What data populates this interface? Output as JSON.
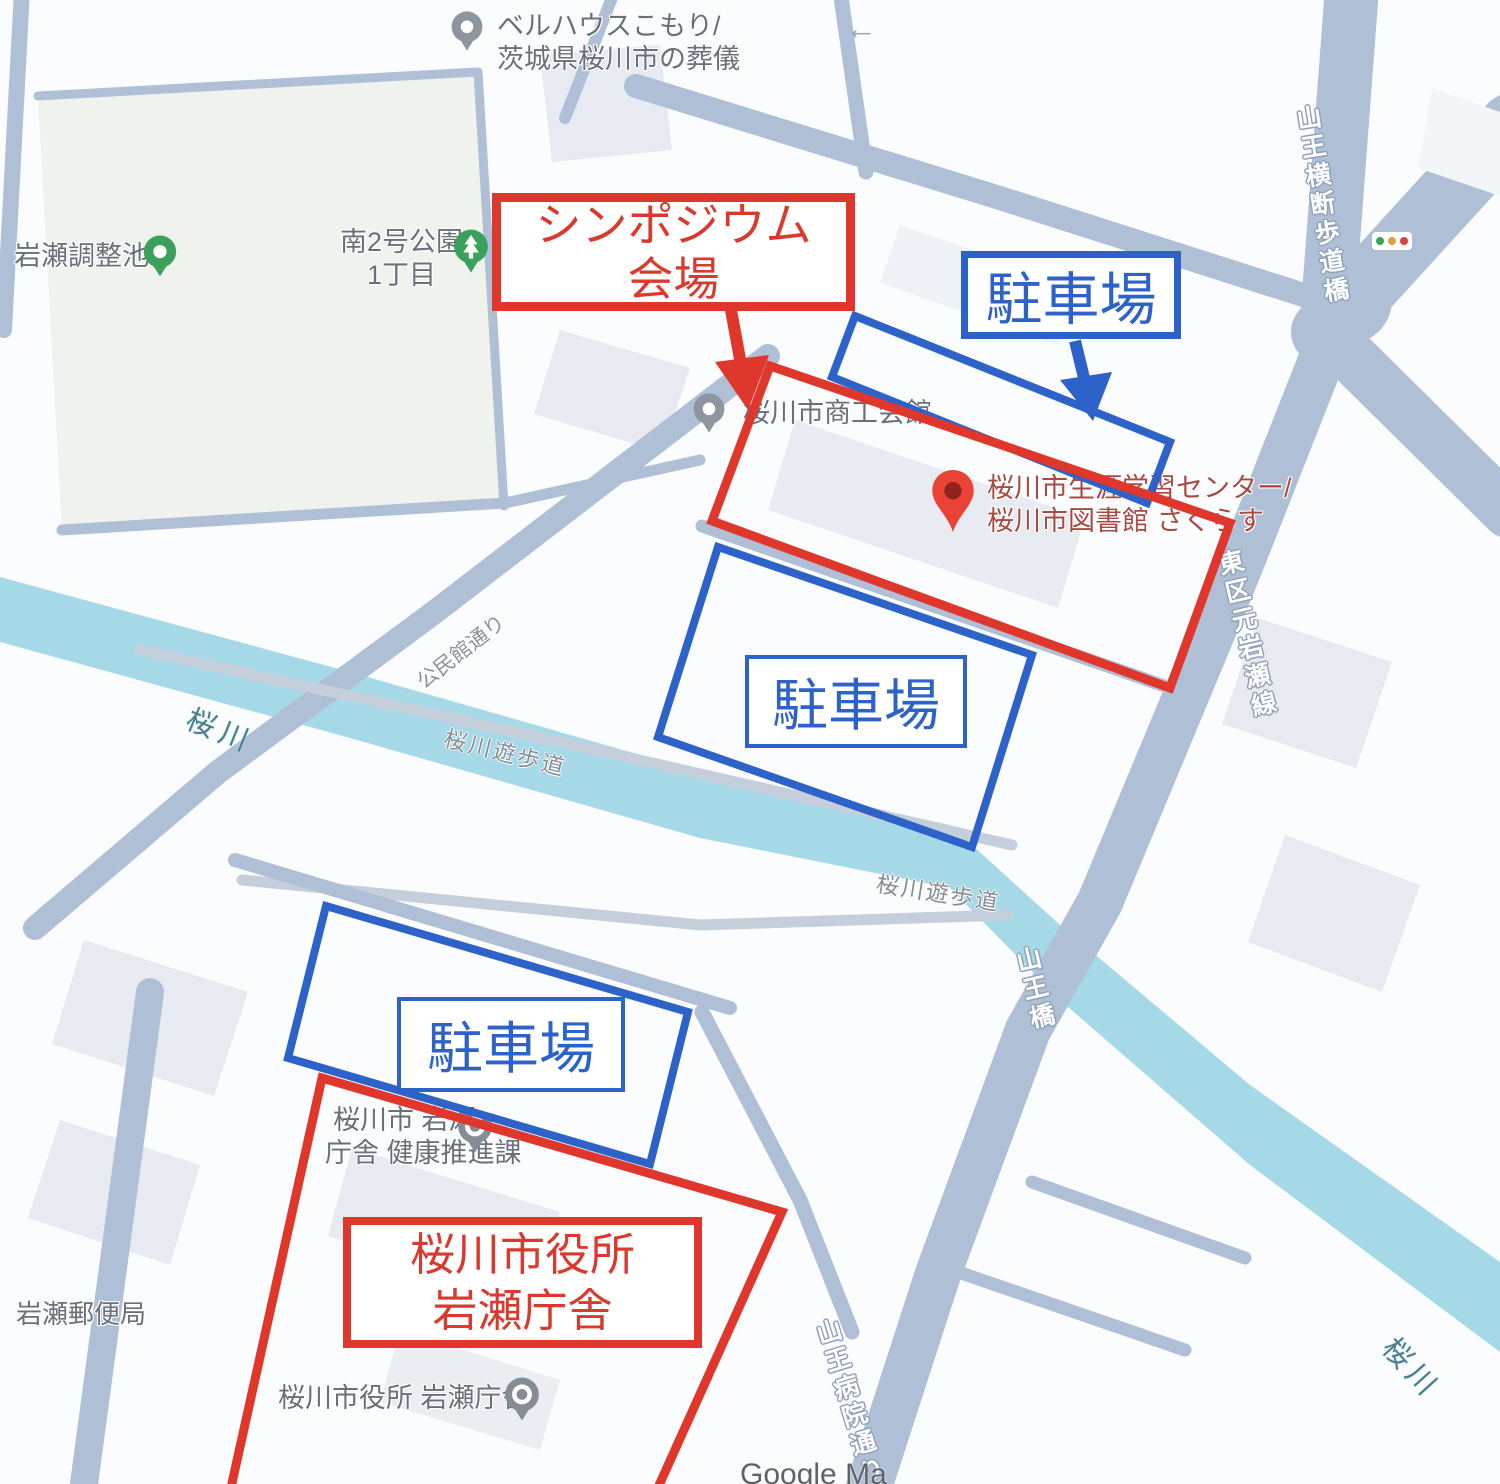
{
  "annotations": {
    "colors": {
      "red": "#e0372c",
      "blue": "#2d63c8"
    },
    "venue_box": {
      "line1": "シンポジウム",
      "line2": "会場"
    },
    "parking_boxes": [
      "駐車場",
      "駐車場",
      "駐車場"
    ],
    "cityhall_box": {
      "line1": "桜川市役所",
      "line2": "岩瀬庁舎"
    }
  },
  "map": {
    "pois": {
      "funeral": {
        "line1": "ベルハウスこもり/",
        "line2": "茨城県桜川市の葬儀"
      },
      "reservoir": "岩瀬調整池B",
      "park": {
        "line1": "南2号公園",
        "line2": "1丁目"
      },
      "chamber": "桜川市商工会館",
      "learning_center": {
        "line1": "桜川市生涯学習センター/",
        "line2": "桜川市図書館 さくらす"
      },
      "iwase_branch": {
        "line1": "桜川市 岩瀬",
        "line2": "庁舎 健康推進課"
      },
      "cityhall_poi": "桜川市役所 岩瀬庁舎",
      "post_office": "岩瀬郵便局"
    },
    "roads": {
      "motoiwase_line": "東区元岩瀬線",
      "sanno_bridge": "山王橋",
      "sanno_ped_bridge": "山王横断歩道橋",
      "sanno_hospital_street": "山王病院通り",
      "local_street": "公民館通り"
    },
    "water": {
      "river_west": "桜川",
      "river_southeast": "桜川"
    },
    "paths": {
      "promenade_north": "桜川遊歩道",
      "promenade_south": "桜川遊歩道"
    },
    "icons": {
      "one_way_arrow": "←"
    },
    "attribution": "Google Ma",
    "base_colors": {
      "road": "#aebfd6",
      "water": "#a6d9e8",
      "park": "#f0f2ee",
      "building": "#e7eaf0"
    }
  }
}
